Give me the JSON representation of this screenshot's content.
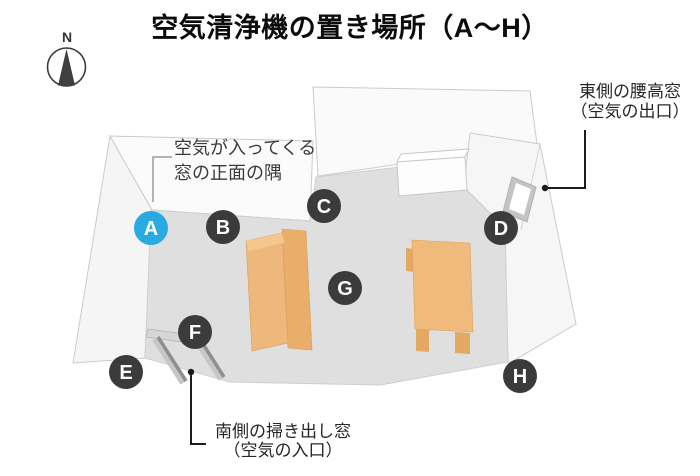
{
  "title": "空気清浄機の置き場所（A～H）",
  "compass": {
    "label": "N"
  },
  "colors": {
    "highlight_blue": "#29abe2",
    "marker_dark": "#3b3b3b",
    "floor_gray": "#dfdfdf",
    "wall_white": "#fafafa",
    "furniture_tan": "#eeb77b",
    "window_gray": "#8f8f8f"
  },
  "markers": [
    {
      "label": "A",
      "color": "#29abe2",
      "highlighted": true
    },
    {
      "label": "B",
      "color": "#3b3b3b",
      "highlighted": false
    },
    {
      "label": "C",
      "color": "#3b3b3b",
      "highlighted": false
    },
    {
      "label": "D",
      "color": "#3b3b3b",
      "highlighted": false
    },
    {
      "label": "E",
      "color": "#3b3b3b",
      "highlighted": false
    },
    {
      "label": "F",
      "color": "#3b3b3b",
      "highlighted": false
    },
    {
      "label": "G",
      "color": "#3b3b3b",
      "highlighted": false
    },
    {
      "label": "H",
      "color": "#3b3b3b",
      "highlighted": false
    }
  ],
  "annotations": {
    "inlet_corner": {
      "line1": "空気が入ってくる",
      "line2": "窓の正面の隅"
    },
    "east_window": {
      "line1": "東側の腰高窓",
      "line2": "（空気の出口）"
    },
    "south_window": {
      "line1": "南側の掃き出し窓",
      "line2": "（空気の入口）"
    }
  }
}
